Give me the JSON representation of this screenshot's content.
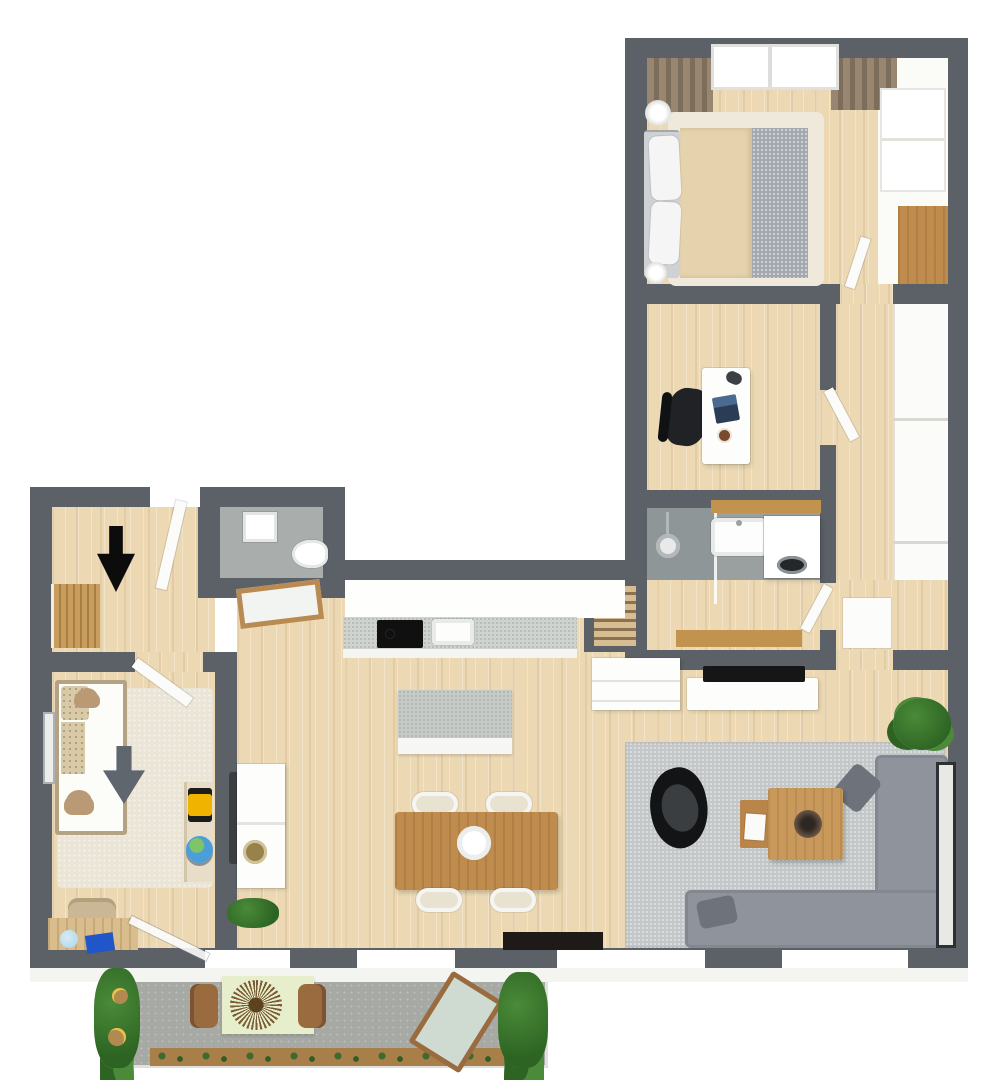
{
  "scene": {
    "type": "3d-floor-plan-top-view",
    "background": "#ffffff",
    "no_text_labels": true
  },
  "palette": {
    "wall": "#5b6167",
    "wood": "#ecd9b4",
    "bath_floor": "#9aa0a0",
    "shower_floor": "#8f9698",
    "wc_floor": "#a9adac",
    "rug_living": "#c4c7c8",
    "rug_kids": "#eae5d6",
    "bed_rug": "#efe9dc",
    "sofa": "#8f939c",
    "sofa_dark": "#6e727b",
    "counter": "#ced3cf",
    "table_wood": "#bf8c4e",
    "coffee_wood": "#c9995c",
    "side_wood": "#b9854a",
    "bench_wood": "#c1934f",
    "door_wood": "#b98a52",
    "curtain": "#988671",
    "curtain_dark": "#7d6e5c",
    "duvet": "#e6d2ac",
    "blanket": "#a3a9ae",
    "headboard": "#cfd2d4",
    "concrete": "#a7a9a5",
    "cloth_green": "#e7eecb",
    "lounger_cushion": "#cfdbd0",
    "lounger_frame": "#9a6b3f",
    "plant": "#4a8a38",
    "plant_dark": "#2d6423",
    "planter_wood": "#a97f49",
    "tv_black": "#161616",
    "bench_black": "#1d1a17",
    "arrow_black": "#0c0c0c",
    "arrow_gray": "#5f666d",
    "gold": "#96824a",
    "frame_dark": "#2e3134",
    "laptop_blue": "#2b3d55",
    "radiator_wood": "#d6bd92",
    "toy_yellow": "#f0b400",
    "toy_blue": "#2156c8",
    "globe_blue": "#4a9fd8",
    "lamp_blue": "#a8d4e8",
    "teddy_brown": "#b99a74",
    "chair_black": "#202225"
  },
  "rooms": [
    {
      "name": "bedroom",
      "furniture": [
        "double-bed",
        "pillows",
        "duvet",
        "knit-blanket",
        "bed-rug",
        "curtains",
        "window",
        "bedside-lamps",
        "wardrobe",
        "desk"
      ]
    },
    {
      "name": "home-office",
      "furniture": [
        "desk",
        "laptop",
        "mug",
        "office-chair",
        "door"
      ]
    },
    {
      "name": "corridor",
      "furniture": [
        "built-in-closets",
        "cabinet"
      ]
    },
    {
      "name": "bathroom",
      "furniture": [
        "shower",
        "glass-partition",
        "washbasin",
        "wood-shelf",
        "washing-machine",
        "bench",
        "towel-radiator",
        "dresser"
      ]
    },
    {
      "name": "wc",
      "furniture": [
        "washbasin",
        "toilet"
      ]
    },
    {
      "name": "entry-hall",
      "furniture": [
        "entrance-arrow",
        "coat-rack",
        "entry-door",
        "wood-doorway-frame"
      ]
    },
    {
      "name": "kids-room",
      "furniture": [
        "kids-bed",
        "teddy-bears",
        "rug",
        "entrance-arrow",
        "wall-picture",
        "toy-shelf",
        "toy-truck",
        "globe",
        "desk",
        "chair",
        "desk-lamp",
        "balcony-glass-door"
      ]
    },
    {
      "name": "kitchen-dining",
      "furniture": [
        "kitchen-counter",
        "cooktop",
        "kitchen-sink",
        "island",
        "dining-table",
        "four-chairs",
        "plate",
        "sideboard",
        "gold-bowl",
        "media-bench",
        "plant"
      ]
    },
    {
      "name": "living-room",
      "furniture": [
        "corner-sofa",
        "cushions",
        "armchair",
        "coffee-table",
        "side-table",
        "bowl",
        "rug",
        "tv",
        "tv-console",
        "dresser",
        "plant",
        "leaning-picture-frame"
      ]
    },
    {
      "name": "balcony",
      "furniture": [
        "outdoor-table",
        "sunburst-centerpiece",
        "two-chairs",
        "sun-lounger",
        "climbing-plants",
        "flower-pots",
        "planter-boxes"
      ]
    }
  ],
  "annotations": {
    "main_entrance_arrow": "black",
    "secondary_entrance_arrow": "gray"
  }
}
